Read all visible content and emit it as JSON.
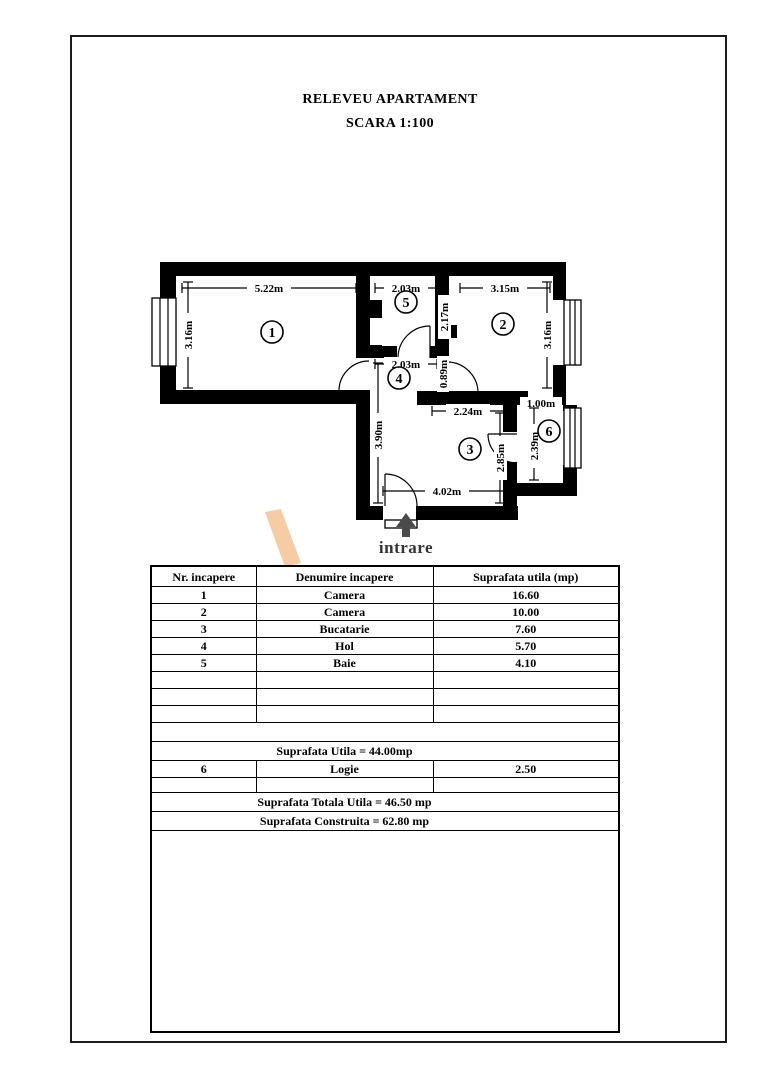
{
  "title": "RELEVEU APARTAMENT",
  "subtitle": "SCARA 1:100",
  "plan": {
    "entrance_label": "intrare",
    "room_numbers": [
      "1",
      "2",
      "3",
      "4",
      "5",
      "6"
    ],
    "dims": {
      "room1_width": "5.22m",
      "room1_height": "3.16m",
      "room5_width": "2.03m",
      "room5_height": "2.17m",
      "room2_width": "3.15m",
      "room2_height": "3.16m",
      "hall_width": "2.03m",
      "niche_height": "0.89m",
      "kitchen_top": "2.24m",
      "logie_width": "1.00m",
      "kitchen_left": "3.90m",
      "kitchen_right": "2.85m",
      "logie_height": "2.39m",
      "kitchen_bottom": "4.02m"
    }
  },
  "table": {
    "headers": [
      "Nr. incapere",
      "Denumire incapere",
      "Suprafata utila (mp)"
    ],
    "rows": [
      {
        "nr": "1",
        "name": "Camera",
        "area": "16.60"
      },
      {
        "nr": "2",
        "name": "Camera",
        "area": "10.00"
      },
      {
        "nr": "3",
        "name": "Bucatarie",
        "area": "7.60"
      },
      {
        "nr": "4",
        "name": "Hol",
        "area": "5.70"
      },
      {
        "nr": "5",
        "name": "Baie",
        "area": "4.10"
      }
    ],
    "suprafata_utila": "Suprafata Utila  =  44.00mp",
    "logie": {
      "nr": "6",
      "name": "Logie",
      "area": "2.50"
    },
    "suprafata_totala": "Suprafata Totala Utila = 46.50 mp",
    "suprafata_construita": "Suprafata Construita  =  62.80 mp"
  },
  "colors": {
    "watermark": "#f5c69b",
    "arrow": "#4a4a4a"
  }
}
